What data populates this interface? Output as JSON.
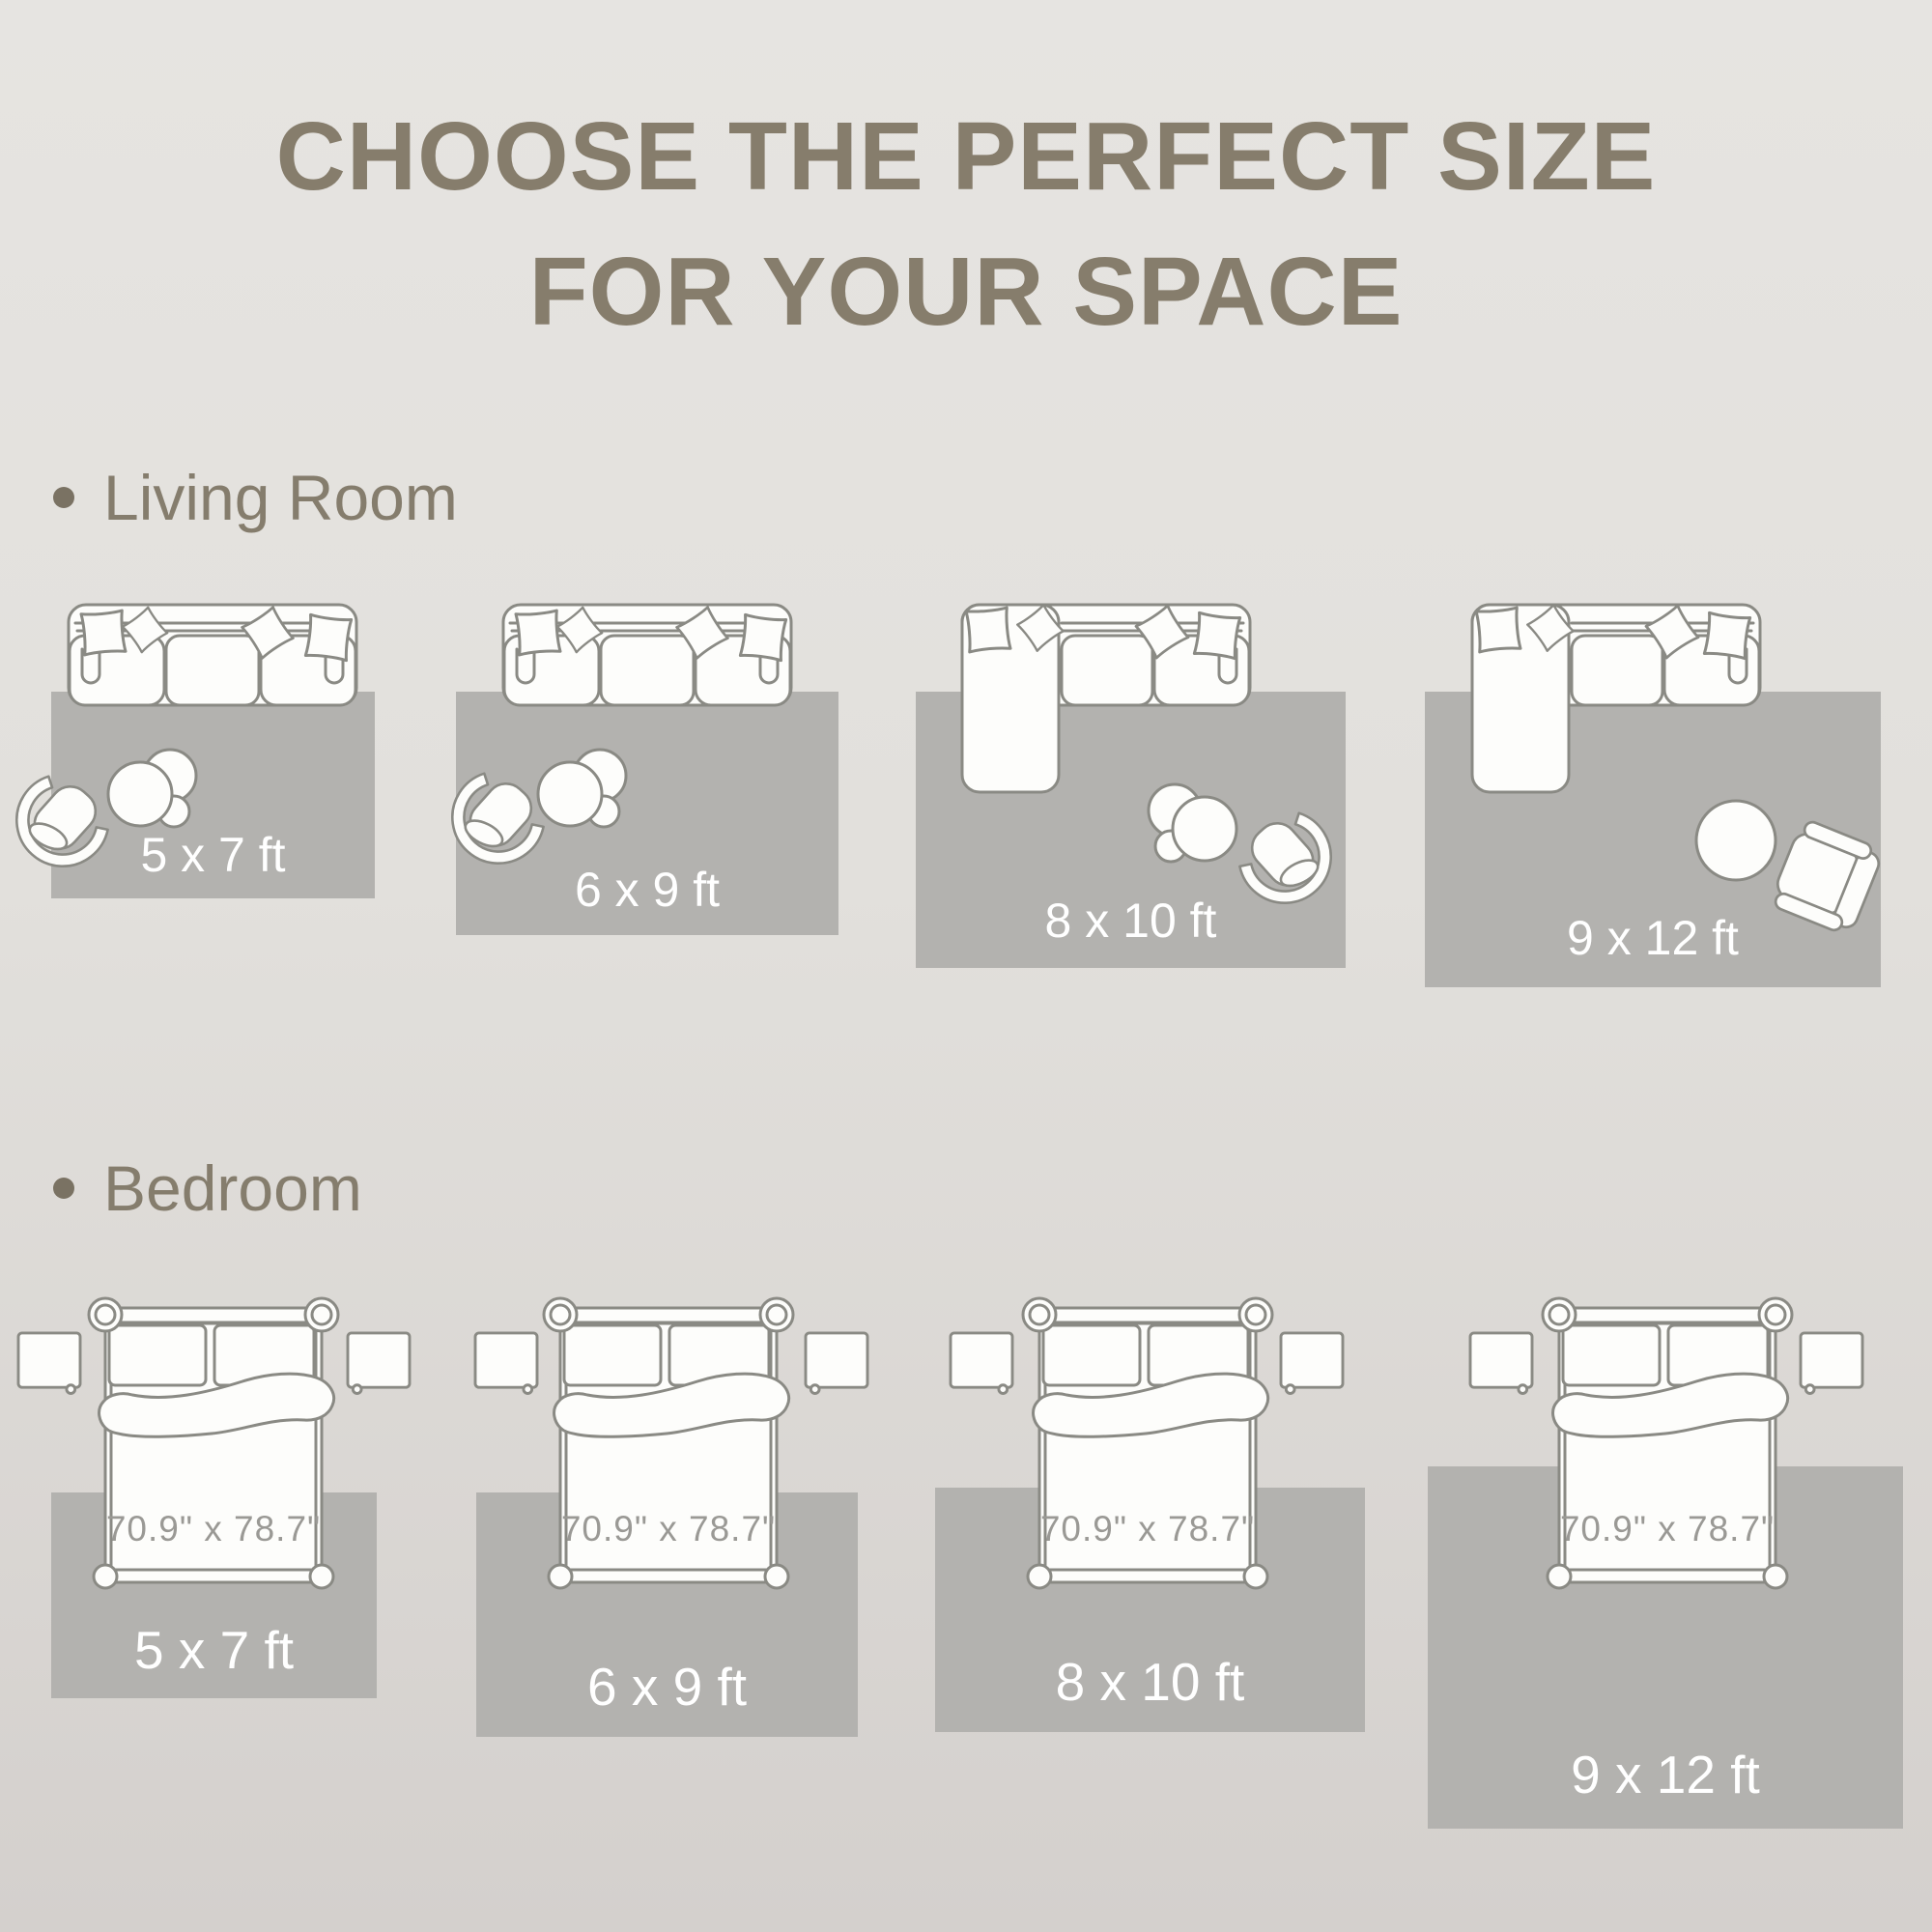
{
  "title": {
    "line1": "CHOOSE THE PERFECT SIZE",
    "line2": "FOR YOUR SPACE"
  },
  "sections": {
    "living_room": {
      "label": "Living Room",
      "rug_sizes": [
        "5 x 7 ft",
        "6 x 9 ft",
        "8 x 10 ft",
        "9 x 12 ft"
      ]
    },
    "bedroom": {
      "label": "Bedroom",
      "rug_sizes": [
        "5 x 7 ft",
        "6 x 9 ft",
        "8 x 10 ft",
        "9 x 12 ft"
      ],
      "bed_size": "70.9\" x 78.7\""
    }
  },
  "colors": {
    "background_top": "#E6E4E1",
    "background_bottom": "#D4D0CD",
    "rug": "#B3B2AF",
    "title": "#867D6C",
    "section_label": "#857D6D",
    "bullet": "#7A7263",
    "furniture_outline": "#8A8A84",
    "furniture_fill": "#FDFDFB",
    "rug_label": "#FFFFFF",
    "bed_dim_label": "#9A9995"
  }
}
